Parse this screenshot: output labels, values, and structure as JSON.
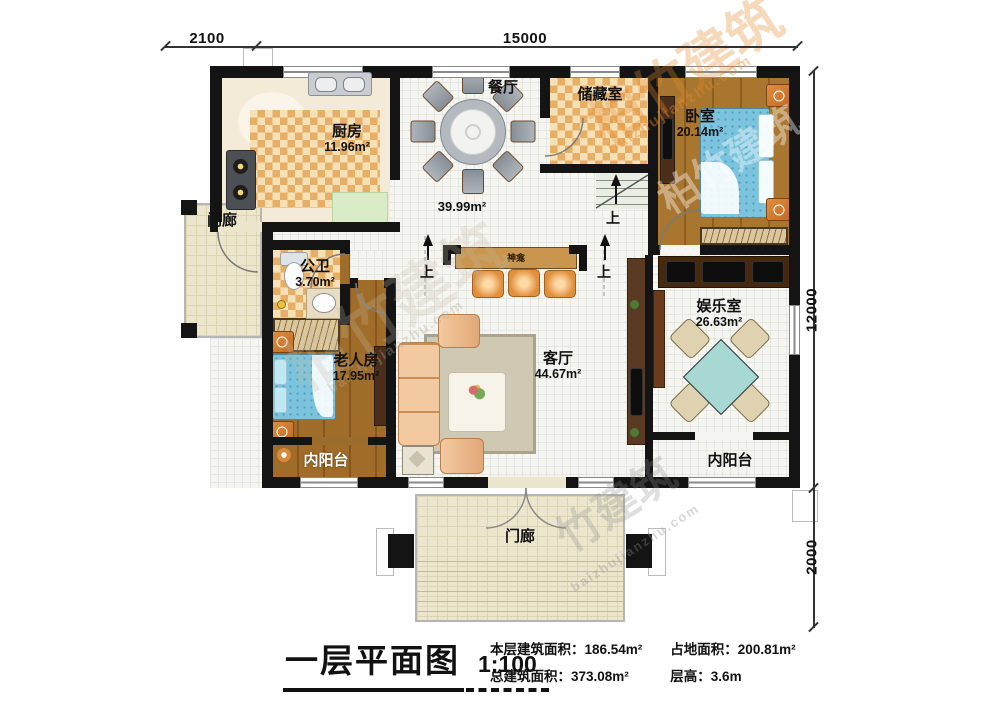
{
  "dimensions": {
    "top_left": "2100",
    "top_main": "15000",
    "right_main": "12000",
    "right_bottom": "2000"
  },
  "rooms": {
    "kitchen": {
      "name": "厨房",
      "area": "11.96m²"
    },
    "dining": {
      "name": "餐厅"
    },
    "hall": {
      "area": "39.99m²"
    },
    "storage": {
      "name": "储藏室"
    },
    "bedroom": {
      "name": "卧室",
      "area": "20.14m²"
    },
    "porch_left": {
      "name": "门廊"
    },
    "bathroom": {
      "name": "公卫",
      "area": "3.70m²"
    },
    "elder_room": {
      "name": "老人房",
      "area": "17.95m²"
    },
    "living": {
      "name": "客厅",
      "area": "44.67m²"
    },
    "entertainment": {
      "name": "娱乐室",
      "area": "26.63m²"
    },
    "balcony_left": {
      "name": "内阳台"
    },
    "balcony_right": {
      "name": "内阳台"
    },
    "porch_bottom": {
      "name": "门廊"
    },
    "shrine": {
      "name": "神龛"
    }
  },
  "annotations": {
    "up": "上"
  },
  "title_block": {
    "title": "一层平面图",
    "scale": "1:100",
    "stats": [
      {
        "label": "本层建筑面积：",
        "value": "186.54m²"
      },
      {
        "label": "总建筑面积：",
        "value": "373.08m²"
      },
      {
        "label": "占地面积：",
        "value": "200.81m²"
      },
      {
        "label": "层高：",
        "value": "3.6m"
      }
    ]
  },
  "watermark": {
    "brand": "柏竹建筑",
    "domain": "baizhujianzhu.com",
    "partial": "竹建筑"
  },
  "colors": {
    "wall": "#141414",
    "checker_dark": "#e7ae66",
    "wood": "#a8762f",
    "bed_blue": "#7cc4dd",
    "table_teal": "#a7d8d3",
    "accent_orange": "#e08f3c"
  }
}
